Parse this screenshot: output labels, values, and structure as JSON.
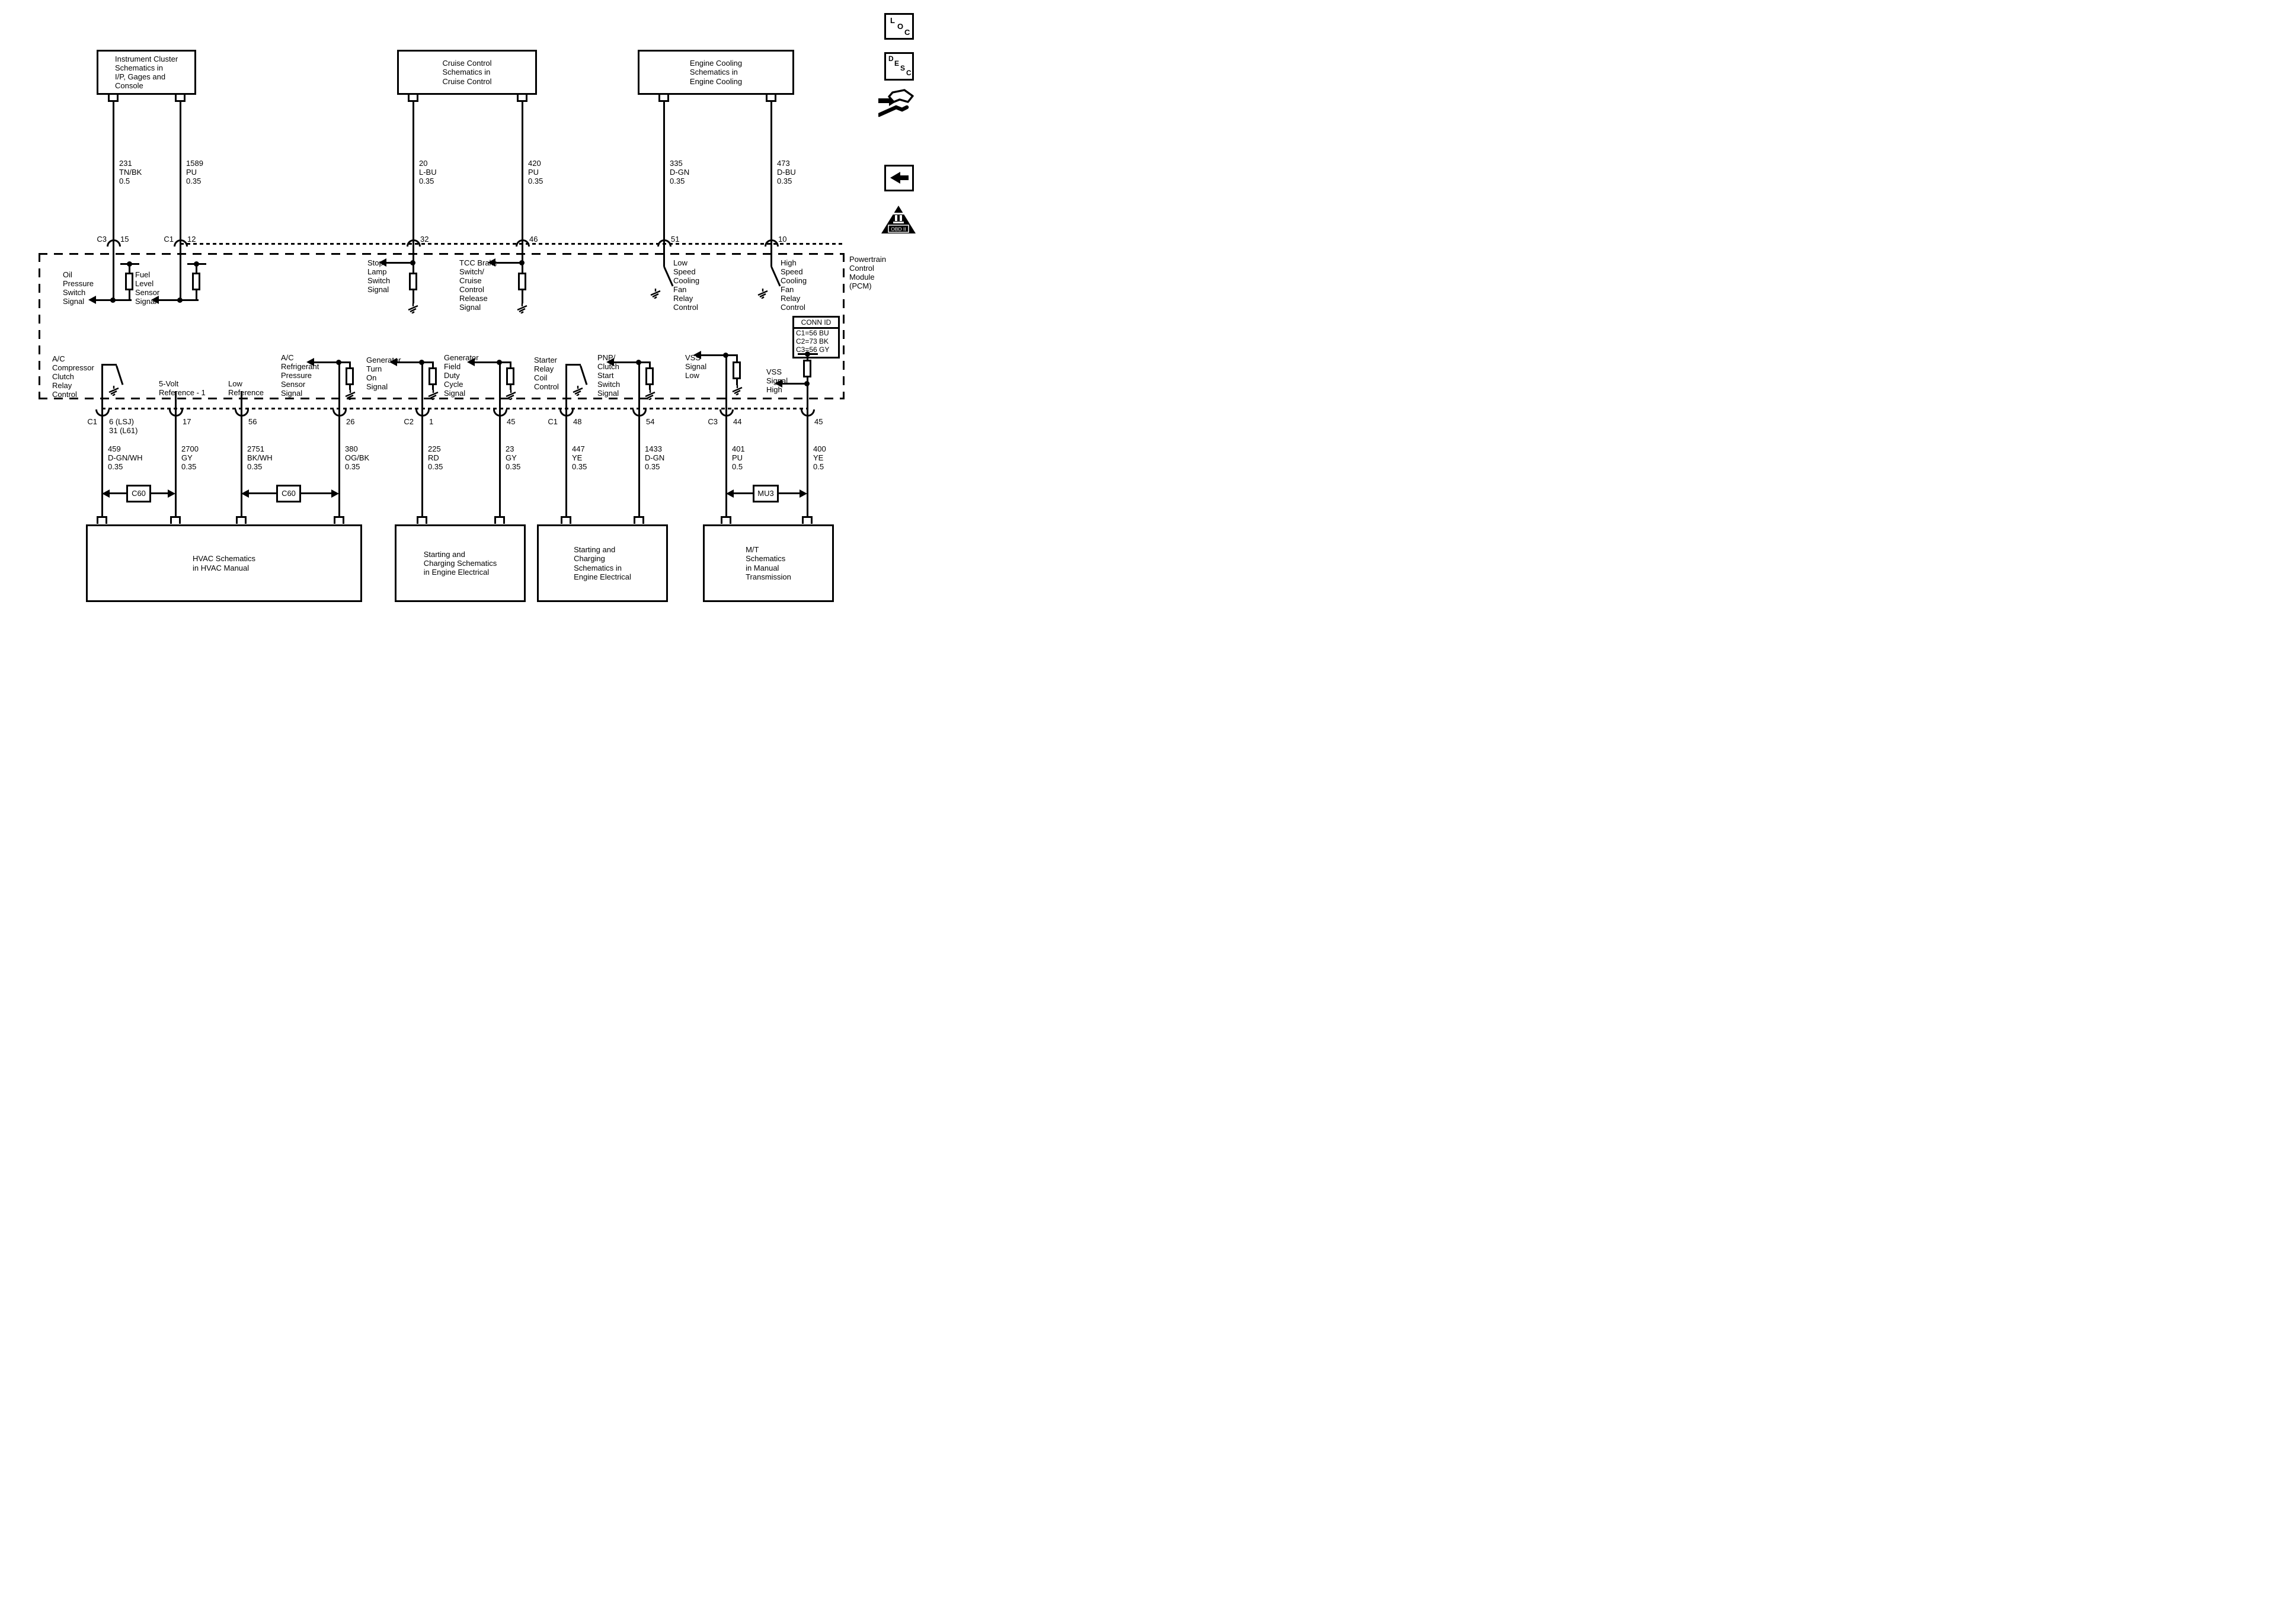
{
  "colors": {
    "ink": "#000000",
    "paper": "#ffffff"
  },
  "top_boxes": [
    {
      "label": "Instrument Cluster\nSchematics in\nI/P, Gages and\nConsole"
    },
    {
      "label": "Cruise Control\nSchematics in\nCruise Control"
    },
    {
      "label": "Engine Cooling\nSchematics in\nEngine Cooling"
    }
  ],
  "top_wires": [
    {
      "conn": "C3",
      "pin": "15",
      "wire": "231\nTN/BK\n0.5",
      "signal": "Oil\nPressure\nSwitch\nSignal"
    },
    {
      "conn": "C1",
      "pin": "12",
      "wire": "1589\nPU\n0.35",
      "signal": "Fuel\nLevel\nSensor\nSignal"
    },
    {
      "pin": "32",
      "wire": "20\nL-BU\n0.35",
      "signal": "Stop\nLamp\nSwitch\nSignal"
    },
    {
      "pin": "46",
      "wire": "420\nPU\n0.35",
      "signal": "TCC Brake\nSwitch/\nCruise\nControl\nRelease\nSignal"
    },
    {
      "pin": "51",
      "wire": "335\nD-GN\n0.35",
      "signal": "Low\nSpeed\nCooling\nFan\nRelay\nControl"
    },
    {
      "pin": "10",
      "wire": "473\nD-BU\n0.35",
      "signal": "High\nSpeed\nCooling\nFan\nRelay\nControl"
    }
  ],
  "pcm": {
    "label": "Powertrain\nControl\nModule\n(PCM)",
    "conn_id_title": "CONN ID",
    "conn_id_rows": "C1=56 BU\nC2=73 BK\nC3=56 GY"
  },
  "bottom_wires": [
    {
      "conn": "C1",
      "pin": "6 (LSJ)\n31 (L61)",
      "wire": "459\nD-GN/WH\n0.35",
      "signal": "A/C\nCompressor\nClutch\nRelay\nControl"
    },
    {
      "pin": "17",
      "wire": "2700\nGY\n0.35",
      "signal": "5-Volt\nReference - 1"
    },
    {
      "pin": "56",
      "wire": "2751\nBK/WH\n0.35",
      "signal": "Low\nReference"
    },
    {
      "pin": "26",
      "wire": "380\nOG/BK\n0.35",
      "signal": "A/C\nRefrigerant\nPressure\nSensor\nSignal"
    },
    {
      "conn": "C2",
      "pin": "1",
      "wire": "225\nRD\n0.35",
      "signal": "Generator\nTurn\nOn\nSignal"
    },
    {
      "pin": "45",
      "wire": "23\nGY\n0.35",
      "signal": "Generator\nField\nDuty\nCycle\nSignal"
    },
    {
      "conn": "C1",
      "pin": "48",
      "wire": "447\nYE\n0.35",
      "signal": "Starter\nRelay\nCoil\nControl"
    },
    {
      "pin": "54",
      "wire": "1433\nD-GN\n0.35",
      "signal": "PNP/\nClutch\nStart\nSwitch\nSignal"
    },
    {
      "conn": "C3",
      "pin": "44",
      "wire": "401\nPU\n0.5",
      "signal": "VSS\nSignal\nLow"
    },
    {
      "pin": "45",
      "wire": "400\nYE\n0.5",
      "signal": "VSS\nSignal\nHigh"
    }
  ],
  "inline_connectors": [
    {
      "label": "C60"
    },
    {
      "label": "C60"
    },
    {
      "label": "MU3"
    }
  ],
  "bottom_boxes": [
    {
      "label": "HVAC Schematics\nin HVAC Manual"
    },
    {
      "label": "Starting and\nCharging Schematics\nin Engine Electrical"
    },
    {
      "label": "Starting and\nCharging\nSchematics in\nEngine Electrical"
    },
    {
      "label": "M/T\nSchematics\nin Manual\nTransmission"
    }
  ],
  "icons": {
    "loc_letters": [
      "L",
      "O",
      "C"
    ],
    "desc_letters": [
      "D",
      "E",
      "S",
      "C"
    ],
    "obd_label": "OBD II"
  }
}
